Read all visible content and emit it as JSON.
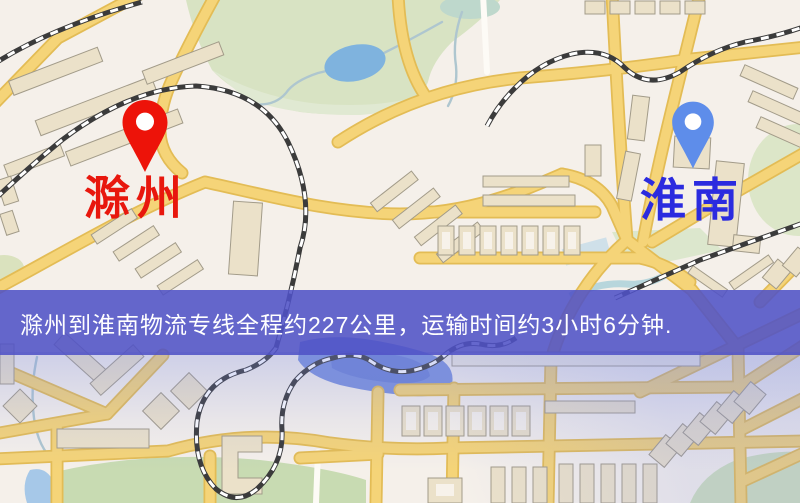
{
  "map": {
    "markers": {
      "origin": {
        "label": "滁州",
        "pin_color": "#ED1309",
        "label_color": "#E8170D",
        "pin_style": "red-teardrop"
      },
      "destination": {
        "label": "淮南",
        "pin_color": "#5E8DEA",
        "label_color": "#2B2BDF",
        "pin_style": "blue-teardrop"
      }
    },
    "banner": {
      "text": "滁州到淮南物流专线全程约227公里，运输时间约3小时6分钟.",
      "background": "#5052C6",
      "text_color": "#FFFFFF",
      "distance_km": 227,
      "duration_text": "3小时6分钟"
    },
    "legend_colors": {
      "background": "#F5F0EA",
      "road": "#F5D478",
      "road_casing": "#E3BC55",
      "water": "#7FB3DE",
      "park": "#D8E3C3",
      "building": "#EBE1C9",
      "railway": "#3B3B3B"
    }
  }
}
